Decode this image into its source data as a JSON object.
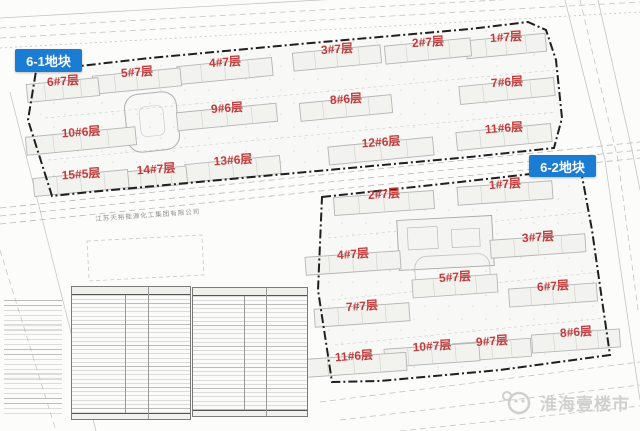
{
  "map": {
    "company_label": "江苏天裕能源化工集团有限公司",
    "plots": [
      {
        "name": "6-1地块",
        "building_angle": -5.5,
        "buildings": [
          {
            "label": "1#7层",
            "x": 506,
            "y": 37,
            "w": 80
          },
          {
            "label": "2#7层",
            "x": 428,
            "y": 42,
            "w": 86
          },
          {
            "label": "3#7层",
            "x": 337,
            "y": 49,
            "w": 88
          },
          {
            "label": "4#7层",
            "x": 225,
            "y": 62,
            "w": 95
          },
          {
            "label": "5#7层",
            "x": 137,
            "y": 72,
            "w": 88
          },
          {
            "label": "6#7层",
            "x": 63,
            "y": 81,
            "w": 72
          },
          {
            "label": "7#6层",
            "x": 507,
            "y": 82,
            "w": 95
          },
          {
            "label": "8#6层",
            "x": 346,
            "y": 99,
            "w": 92
          },
          {
            "label": "9#6层",
            "x": 227,
            "y": 108,
            "w": 100
          },
          {
            "label": "10#6层",
            "x": 81,
            "y": 132,
            "w": 110
          },
          {
            "label": "11#6层",
            "x": 504,
            "y": 128,
            "w": 95
          },
          {
            "label": "12#6层",
            "x": 381,
            "y": 142,
            "w": 105
          },
          {
            "label": "13#6层",
            "x": 233,
            "y": 160,
            "w": 95
          },
          {
            "label": "14#7层",
            "x": 156,
            "y": 169,
            "w": 62
          },
          {
            "label": "15#5层",
            "x": 81,
            "y": 174,
            "w": 95
          }
        ]
      },
      {
        "name": "6-2地块",
        "building_angle": -4,
        "buildings": [
          {
            "label": "1#7层",
            "x": 505,
            "y": 184,
            "w": 95
          },
          {
            "label": "2#7层",
            "x": 384,
            "y": 194,
            "w": 100
          },
          {
            "label": "3#7层",
            "x": 538,
            "y": 237,
            "w": 95
          },
          {
            "label": "4#7层",
            "x": 353,
            "y": 254,
            "w": 95
          },
          {
            "label": "5#7层",
            "x": 455,
            "y": 277,
            "w": 85
          },
          {
            "label": "6#7层",
            "x": 553,
            "y": 286,
            "w": 88
          },
          {
            "label": "7#7层",
            "x": 362,
            "y": 306,
            "w": 95
          },
          {
            "label": "8#6层",
            "x": 576,
            "y": 332,
            "w": 88
          },
          {
            "label": "9#7层",
            "x": 492,
            "y": 341,
            "w": 78
          },
          {
            "label": "10#7层",
            "x": 432,
            "y": 346,
            "w": 95
          },
          {
            "label": "11#6层",
            "x": 354,
            "y": 356,
            "w": 105
          }
        ]
      }
    ],
    "watermark": {
      "text": "淮海壹楼市"
    },
    "colors": {
      "badge_bg": "#1a7cd3",
      "label_red": "#c43b3c",
      "watermark_gray": "#c9c9c9",
      "line_gray": "#b5b5b5",
      "boundary_black": "#1f1f1f"
    }
  }
}
